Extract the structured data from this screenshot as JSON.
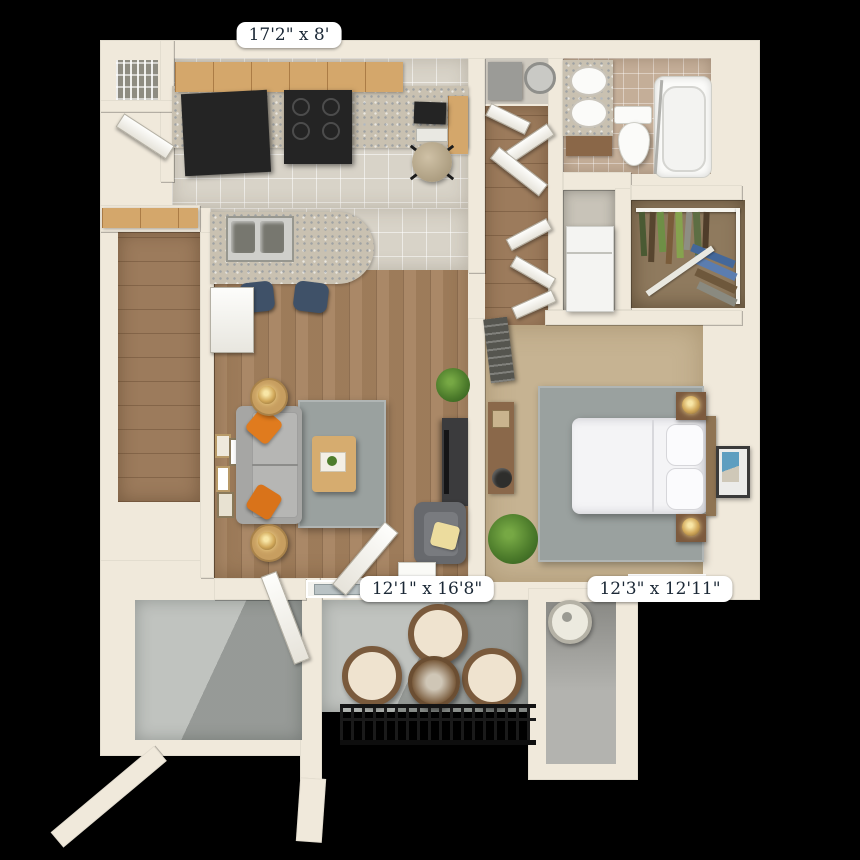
{
  "title": "One-bedroom apartment 3D floor plan",
  "labels": {
    "kitchen": "17'2\" x 8'",
    "living": "12'1\" x 16'8\"",
    "bedroom": "12'3\" x 12'11\""
  },
  "rooms": [
    {
      "name": "kitchen",
      "dimensions": "17'2\" x 8'"
    },
    {
      "name": "living-room",
      "dimensions": "12'1\" x 16'8\""
    },
    {
      "name": "bedroom",
      "dimensions": "12'3\" x 12'11\""
    }
  ],
  "colors": {
    "background": "#000000",
    "wall": "#f0e9db",
    "kitchen_tile": "#d8d3c8",
    "wood_floor": "#a5825f",
    "bedroom_carpet": "#c6b392",
    "area_rug": "#9aa19f",
    "patio_concrete": "#c0c3bf",
    "cabinet_wood": "#d4a76b",
    "counter_granite": "#c9c1b1",
    "appliance_black": "#242424",
    "sofa_gray": "#a6a6a4",
    "pillow_orange": "#e07b1e",
    "label_text": "#1b2836",
    "label_bg": "#ffffff"
  }
}
